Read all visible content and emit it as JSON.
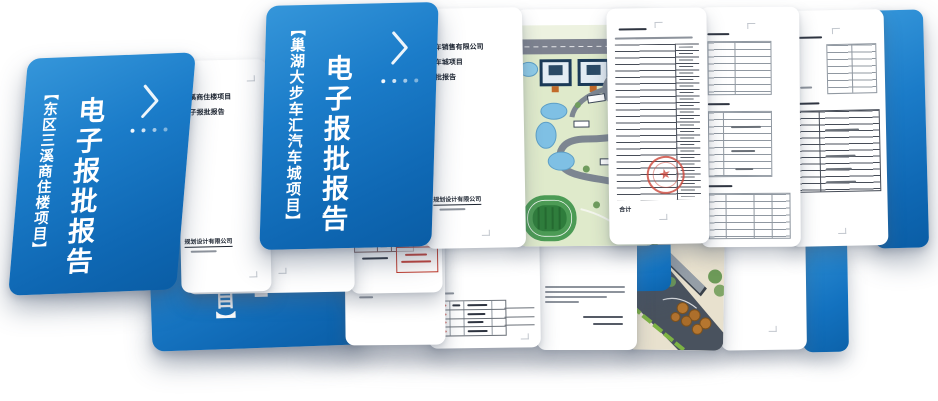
{
  "colors": {
    "cover_blue": "#1678c6",
    "cover_blue_dark": "#0a5da5",
    "page_white": "#ffffff",
    "ink": "#1c2430",
    "seal_red": "#cd463a",
    "annotation_red": "#c0392b",
    "map_green": "#dfeacb",
    "road_gray": "#7d828f"
  },
  "icons": {
    "chevron_next": "next-chevron",
    "pagination_dots": "4-dots",
    "approval_seal": "red-circular-seal"
  },
  "covers": {
    "left": {
      "project": "【东区三溪商住楼项目】",
      "title": "电子报批报告"
    },
    "middle": {
      "project": "【巢湖大步车汇汽车城项目】",
      "title": "电子报批报告"
    },
    "back": {
      "visible_text": "目】"
    }
  },
  "pages": {
    "left_title_page": {
      "line1": "三溪商住楼项目",
      "line2": "电子报批报告",
      "footer": "规划设计有限公司"
    },
    "middle_title_page": {
      "line1": "汽车销售有限公司",
      "line2": "汽车城项目",
      "line3": "报批报告",
      "footer": "规划设计有限公司"
    },
    "detail_table_page": {
      "total_label": "合计"
    }
  }
}
